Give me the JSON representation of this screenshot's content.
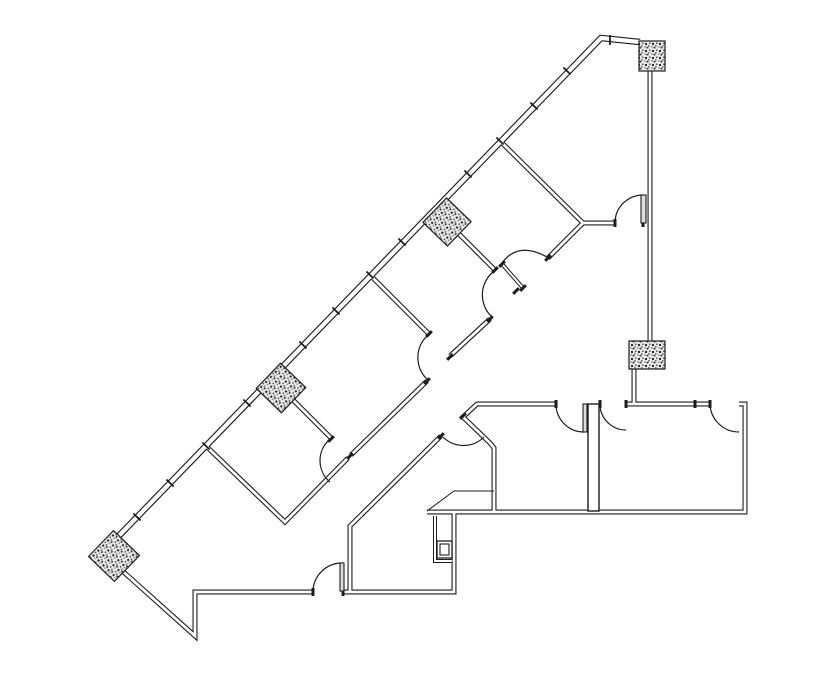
{
  "meta": {
    "canvas_width": 835,
    "canvas_height": 678,
    "background_color": "#ffffff",
    "line_color": "#1c1c1c",
    "column_speckle_dark": "#2a2a2a",
    "column_speckle_mid": "#6f6f6f",
    "column_speckle_light": "#e9e9e9"
  },
  "diagram": {
    "type": "floor-plan",
    "walls": [
      {
        "name": "exterior-diagonal-wall-and-top-wall",
        "weight": "exterior",
        "pts": [
          [
            110,
            545
          ],
          [
            601,
            38
          ],
          [
            640,
            42
          ]
        ]
      },
      {
        "name": "east-wall-upper",
        "weight": "interior",
        "pts": [
          [
            650,
            71
          ],
          [
            650,
            343
          ]
        ]
      },
      {
        "name": "east-wall-column-stub",
        "weight": "interior",
        "pts": [
          [
            634,
            368
          ],
          [
            634,
            404
          ]
        ]
      },
      {
        "name": "partition-p0-and-tr-room-wall",
        "weight": "interior",
        "pts": [
          [
            500,
            141
          ],
          [
            583,
            223
          ],
          [
            615,
            223
          ]
        ]
      },
      {
        "name": "corridor-wall-ne-segment",
        "weight": "interior",
        "pts": [
          [
            548,
            258
          ],
          [
            583,
            223
          ]
        ]
      },
      {
        "name": "partition-p1",
        "weight": "interior",
        "pts": [
          [
            456,
            231
          ],
          [
            495,
            270
          ]
        ]
      },
      {
        "name": "partition-p2",
        "weight": "interior",
        "pts": [
          [
            370,
            275
          ],
          [
            429,
            334
          ]
        ]
      },
      {
        "name": "partition-p3",
        "weight": "interior",
        "pts": [
          [
            288,
            395
          ],
          [
            331,
            438
          ]
        ]
      },
      {
        "name": "partition-p4-and-corridor-wall-sw",
        "weight": "interior",
        "pts": [
          [
            206,
            446
          ],
          [
            285,
            522
          ],
          [
            348,
            458
          ]
        ]
      },
      {
        "name": "corridor-wall-mid-segment-a",
        "weight": "interior",
        "pts": [
          [
            490,
            319
          ],
          [
            450,
            356
          ]
        ]
      },
      {
        "name": "corridor-wall-mid-segment-b",
        "weight": "interior",
        "pts": [
          [
            427,
            381
          ],
          [
            351,
            455
          ]
        ]
      },
      {
        "name": "corridor-wall-se-and-stair-vertical",
        "weight": "interior",
        "pts": [
          [
            441,
            436
          ],
          [
            350,
            526
          ],
          [
            350,
            592
          ]
        ]
      },
      {
        "name": "wing-top-wall-left-and-entry-chamfer-and-bay",
        "weight": "interior",
        "pts": [
          [
            556,
            404
          ],
          [
            477,
            404
          ],
          [
            463,
            417
          ],
          [
            490,
            443
          ],
          [
            494,
            448
          ],
          [
            494,
            511
          ]
        ]
      },
      {
        "name": "wing-top-wall-right",
        "weight": "interior",
        "pts": [
          [
            626,
            404
          ],
          [
            710,
            404
          ]
        ]
      },
      {
        "name": "wing-right-and-bottom-wall",
        "weight": "interior",
        "pts": [
          [
            739,
            404
          ],
          [
            745,
            404
          ],
          [
            745,
            512
          ],
          [
            427,
            512
          ]
        ]
      },
      {
        "name": "wing-step-down-wall",
        "weight": "interior",
        "pts": [
          [
            343,
            592
          ],
          [
            454,
            592
          ],
          [
            454,
            513
          ]
        ]
      },
      {
        "name": "southwest-point-wall",
        "weight": "interior",
        "pts": [
          [
            118,
            567
          ],
          [
            195,
            636
          ],
          [
            195,
            592
          ],
          [
            313,
            592
          ]
        ]
      },
      {
        "name": "closet-wall",
        "weight": "thin",
        "pts": [
          [
            435,
            516
          ],
          [
            435,
            561
          ],
          [
            452,
            561
          ]
        ]
      },
      {
        "name": "office0-door-leaf",
        "weight": "thin",
        "pts": [
          [
            502,
            264
          ],
          [
            523,
            288
          ]
        ]
      }
    ],
    "columns": [
      {
        "name": "column-top-right",
        "shape": "rect",
        "x": 639,
        "y": 41,
        "w": 26,
        "h": 30
      },
      {
        "name": "column-mid-right",
        "shape": "rect",
        "x": 629,
        "y": 341,
        "w": 36,
        "h": 28
      },
      {
        "name": "column-diag-1",
        "shape": "rot",
        "cx": 447,
        "cy": 222,
        "size": 34,
        "angle": -46
      },
      {
        "name": "column-diag-2",
        "shape": "rot",
        "cx": 281,
        "cy": 388,
        "size": 35,
        "angle": -46
      },
      {
        "name": "column-diag-3",
        "shape": "rot",
        "cx": 114,
        "cy": 556,
        "size": 36,
        "angle": -46
      }
    ],
    "doors": [
      {
        "name": "door-arc-top-right-room",
        "path": "M615,222 A28,28 0 0 1 643,195"
      },
      {
        "name": "door-arc-office0-swing",
        "path": "M502,263 Q518,241 547,257"
      },
      {
        "name": "door-arc-office2",
        "path": "M493,272 A30,30 0 0 0 492,317"
      },
      {
        "name": "door-arc-office3",
        "path": "M427,336 A30,30 0 0 0 428,380"
      },
      {
        "name": "door-arc-office4",
        "path": "M329,440 A28,28 0 0 0 330,482"
      },
      {
        "name": "door-arc-office5",
        "path": "M313,591 A29,29 0 0 1 342,563"
      },
      {
        "name": "door-arc-entry-bay",
        "path": "M443,437 A29,29 0 0 0 484,437"
      },
      {
        "name": "door-arc-wing-room1",
        "path": "M556,404 A28,28 0 0 0 584,432"
      },
      {
        "name": "door-arc-wing-room2",
        "path": "M600,404 A26,26 0 0 0 626,430"
      },
      {
        "name": "door-arc-wing-room3",
        "path": "M710,403 A29,29 0 0 0 739,432"
      }
    ],
    "leaves": [
      {
        "name": "door-leaf-top-right-room",
        "x": 641,
        "y": 195,
        "w": 5,
        "h": 28
      },
      {
        "name": "door-leaf-office5",
        "x": 340,
        "y": 563,
        "w": 4,
        "h": 28
      },
      {
        "name": "door-leaf-wing-room1",
        "x": 583,
        "y": 404,
        "w": 4,
        "h": 28
      }
    ],
    "window_ticks": [
      {
        "x": 567,
        "y": 71,
        "angle": 44
      },
      {
        "x": 534,
        "y": 106,
        "angle": 44
      },
      {
        "x": 468,
        "y": 174,
        "angle": 44
      },
      {
        "x": 402,
        "y": 242,
        "angle": 44
      },
      {
        "x": 336,
        "y": 311,
        "angle": 44
      },
      {
        "x": 303,
        "y": 345,
        "angle": 44
      },
      {
        "x": 247,
        "y": 403,
        "angle": 44
      },
      {
        "x": 170,
        "y": 483,
        "angle": 44
      },
      {
        "x": 137,
        "y": 517,
        "angle": 44
      },
      {
        "x": 500,
        "y": 141,
        "angle": 44
      },
      {
        "x": 370,
        "y": 275,
        "angle": 44
      },
      {
        "x": 206,
        "y": 446,
        "angle": 44
      },
      {
        "x": 610,
        "y": 40,
        "angle": 90
      }
    ],
    "jambs": [
      {
        "x": 516,
        "y": 291,
        "angle": -45
      },
      {
        "x": 548,
        "y": 258,
        "angle": -45
      },
      {
        "x": 495,
        "y": 270,
        "angle": -45
      },
      {
        "x": 490,
        "y": 319,
        "angle": -45
      },
      {
        "x": 450,
        "y": 357,
        "angle": -45
      },
      {
        "x": 427,
        "y": 381,
        "angle": -45
      },
      {
        "x": 429,
        "y": 334,
        "angle": -45
      },
      {
        "x": 331,
        "y": 439,
        "angle": -45
      },
      {
        "x": 350,
        "y": 456,
        "angle": -45
      },
      {
        "x": 441,
        "y": 436,
        "angle": -45
      },
      {
        "x": 463,
        "y": 416,
        "angle": -45
      },
      {
        "x": 502,
        "y": 264,
        "angle": -45
      },
      {
        "x": 523,
        "y": 288,
        "angle": -45
      },
      {
        "x": 615,
        "y": 223,
        "angle": 90
      },
      {
        "x": 643,
        "y": 223,
        "angle": 90
      },
      {
        "x": 556,
        "y": 404,
        "angle": 90
      },
      {
        "x": 600,
        "y": 404,
        "angle": 90
      },
      {
        "x": 626,
        "y": 404,
        "angle": 90
      },
      {
        "x": 695,
        "y": 404,
        "angle": 90
      },
      {
        "x": 710,
        "y": 404,
        "angle": 90
      },
      {
        "x": 313,
        "y": 592,
        "angle": 90
      },
      {
        "x": 343,
        "y": 592,
        "angle": 90
      }
    ],
    "details": {
      "shaft_wall": {
        "name": "shaft-wall",
        "x": 588,
        "y": 404,
        "w": 11,
        "h": 107
      },
      "cabinet_outer": {
        "name": "cabinet-outer",
        "x": 437,
        "y": 541,
        "w": 15,
        "h": 17
      },
      "cabinet_inner": {
        "name": "cabinet-inner",
        "x": 440,
        "y": 544,
        "w": 9,
        "h": 11
      },
      "counter": {
        "name": "counter-line",
        "pts": [
          [
            427,
            511
          ],
          [
            454,
            491
          ],
          [
            494,
            491
          ]
        ]
      }
    }
  }
}
